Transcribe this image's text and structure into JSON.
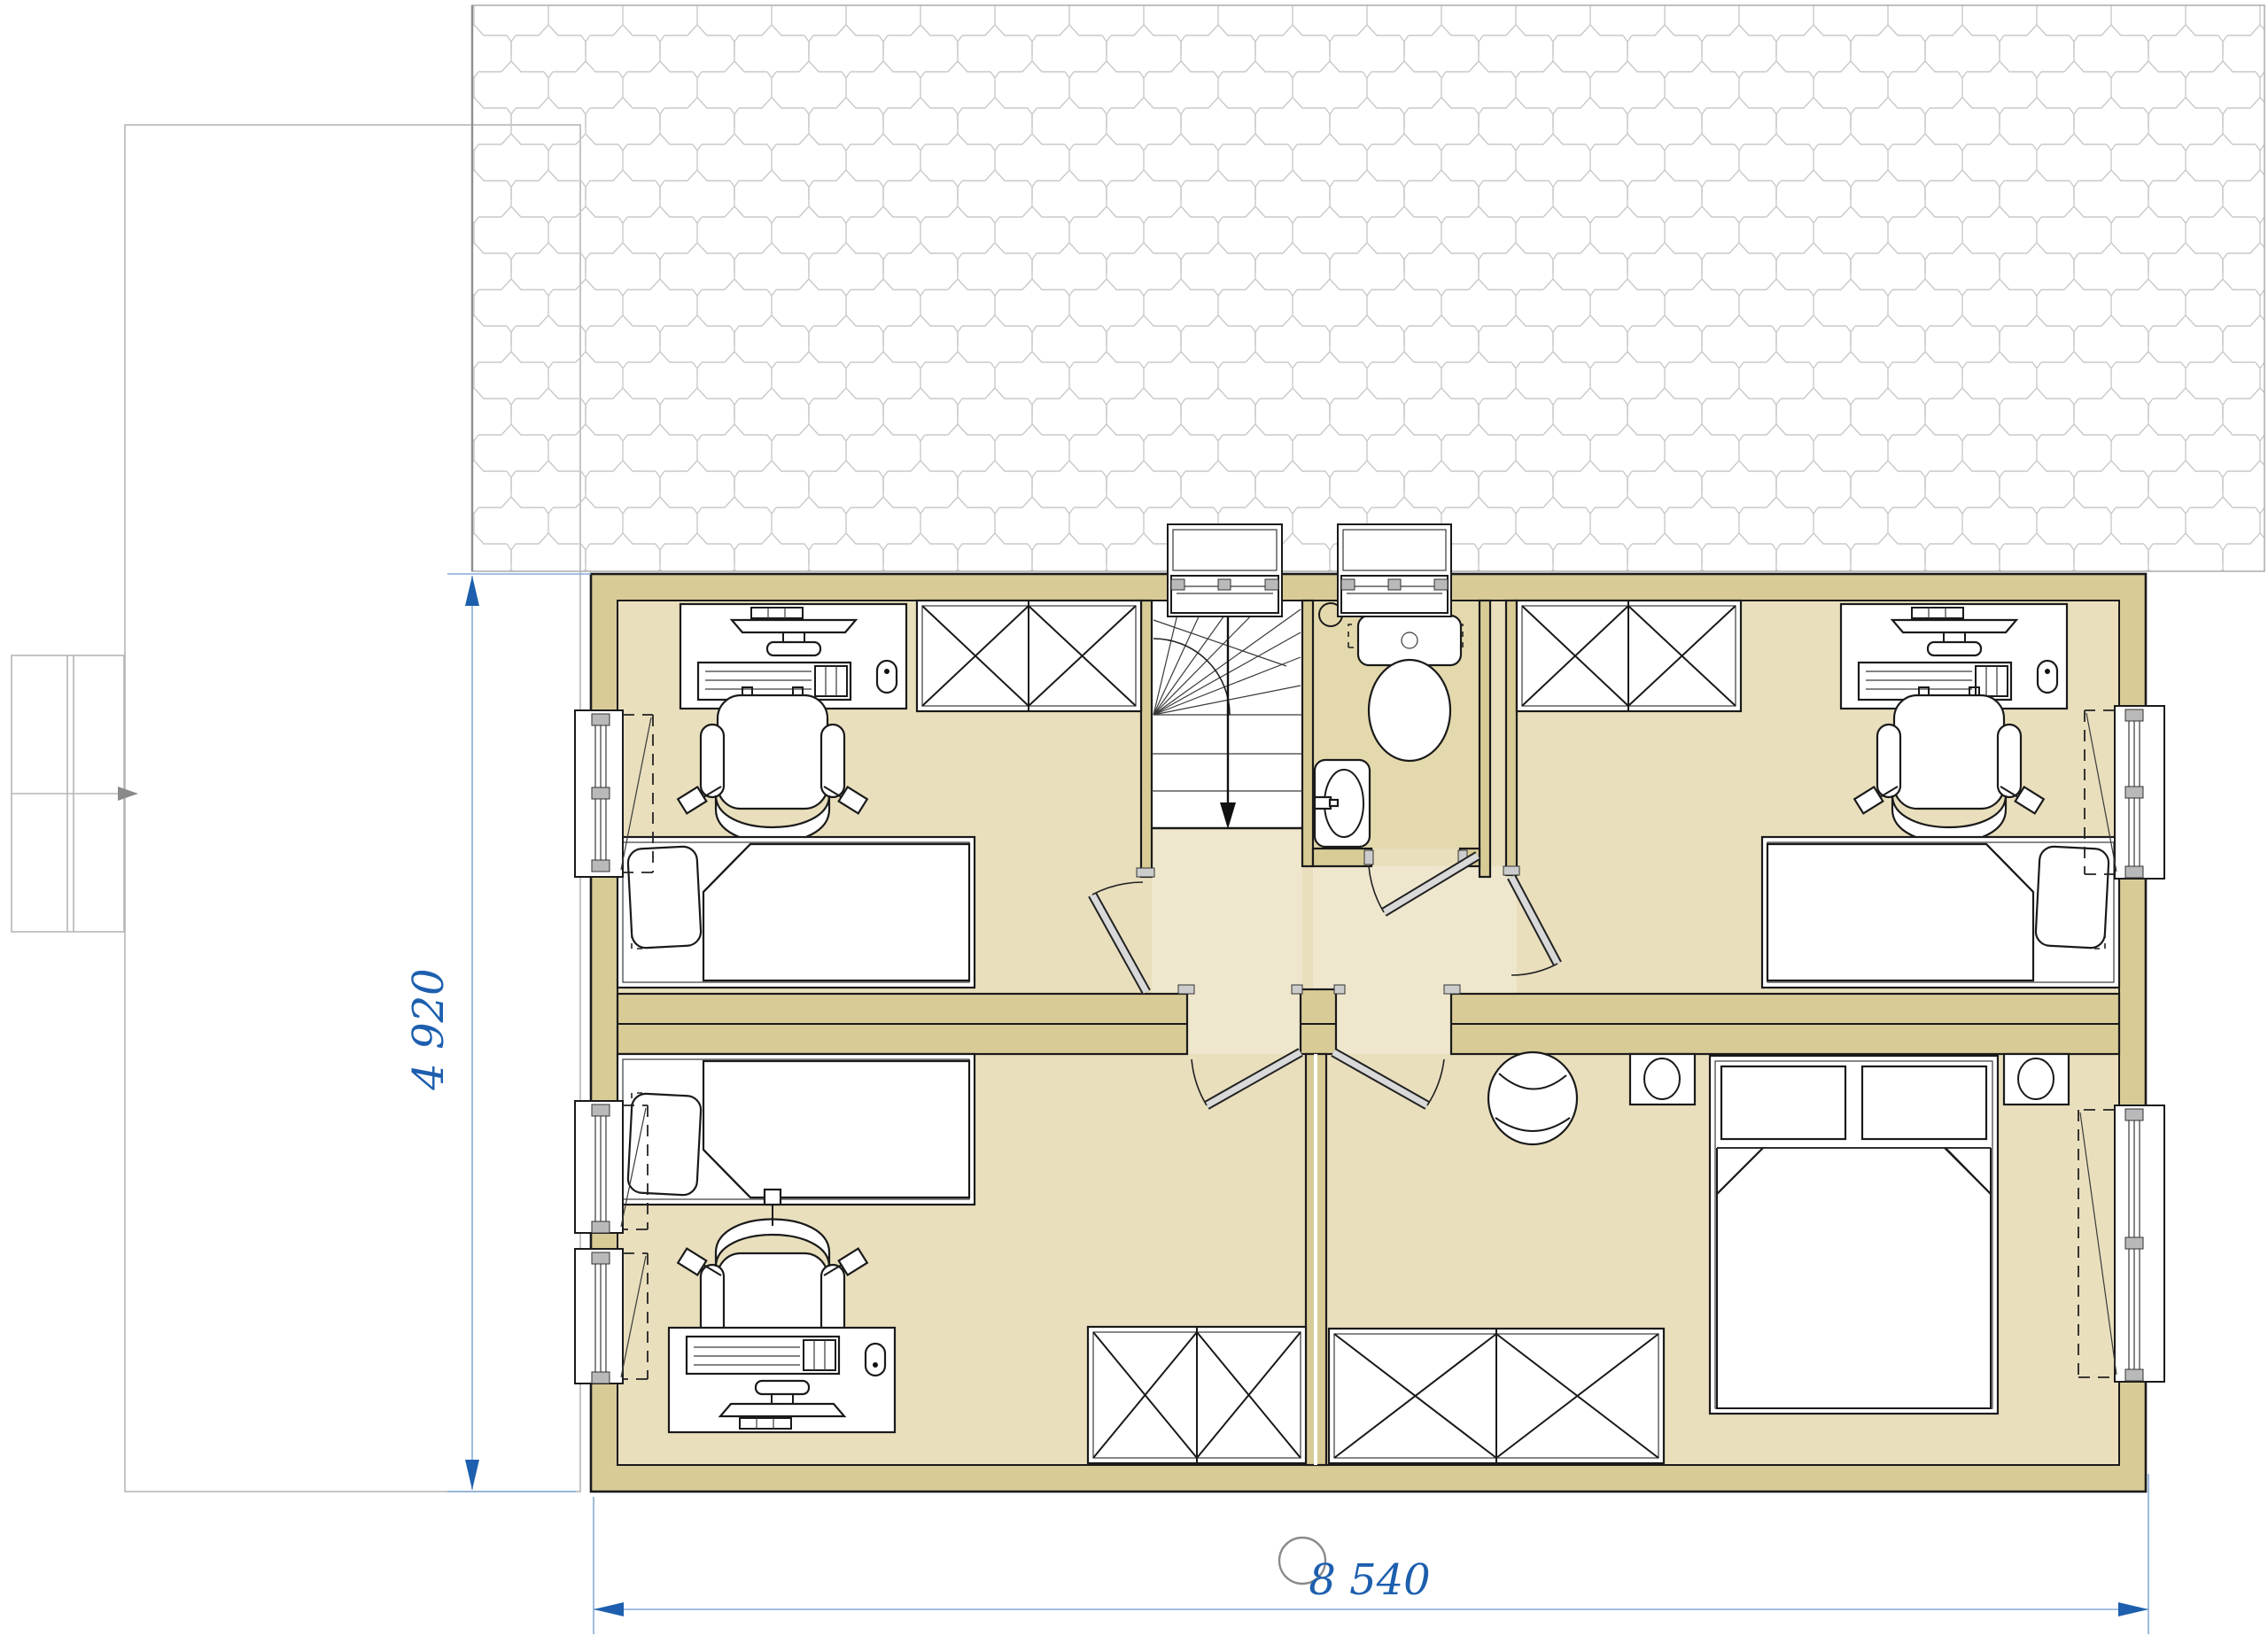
{
  "drawing": {
    "type": "architectural-floor-plan",
    "view": "upper-floor-plan-with-roof-hatch",
    "dimensions": {
      "horizontal_label": "8 540",
      "vertical_label": "4 920"
    },
    "colors": {
      "wall": "#d8cb96",
      "floor": "#e9dfbd",
      "hall": "#efe7cd",
      "bath": "#e4d9ad",
      "line": "#1a1a1a",
      "roofLine": "#c9c9c9",
      "faint": "#b6b6b6",
      "dimBlue": "#1d5fae",
      "dimLine": "#85abd7",
      "leaf": "#d9d9d9",
      "paper": "#ffffff"
    },
    "rooms": [
      {
        "id": "bedroom-top-left",
        "furniture": [
          "computer-desk",
          "office-chair",
          "wardrobe-x2",
          "single-bed-pillow-left",
          "window-left-wall"
        ]
      },
      {
        "id": "bedroom-top-right",
        "furniture": [
          "wardrobe-x2",
          "computer-desk",
          "office-chair",
          "single-bed-pillow-right",
          "window-right-wall"
        ]
      },
      {
        "id": "bedroom-bottom-left",
        "furniture": [
          "single-bed-pillow-left",
          "office-chair",
          "computer-desk",
          "wardrobe-x2",
          "two-windows-left-wall"
        ]
      },
      {
        "id": "master-bedroom",
        "furniture": [
          "round-armchair",
          "nightstand-lamp",
          "double-bed-two-pillows",
          "nightstand-lamp",
          "wardrobe-x2",
          "window-right-wall"
        ]
      },
      {
        "id": "bathroom",
        "furniture": [
          "floor-drain",
          "toilet",
          "washbasin",
          "roof-window"
        ]
      },
      {
        "id": "stairwell",
        "furniture": [
          "winder-staircase",
          "down-arrow",
          "roof-window"
        ]
      },
      {
        "id": "hall",
        "furniture": [
          "door-top-left-bedroom",
          "door-bottom-left-bedroom",
          "door-master-bedroom",
          "door-bathroom",
          "door-top-right-bedroom"
        ]
      }
    ],
    "annotations": [
      "roof-shingle-hatch",
      "ground-floor-outline",
      "entry-arrow",
      "bottom-center-circle-marker"
    ]
  }
}
